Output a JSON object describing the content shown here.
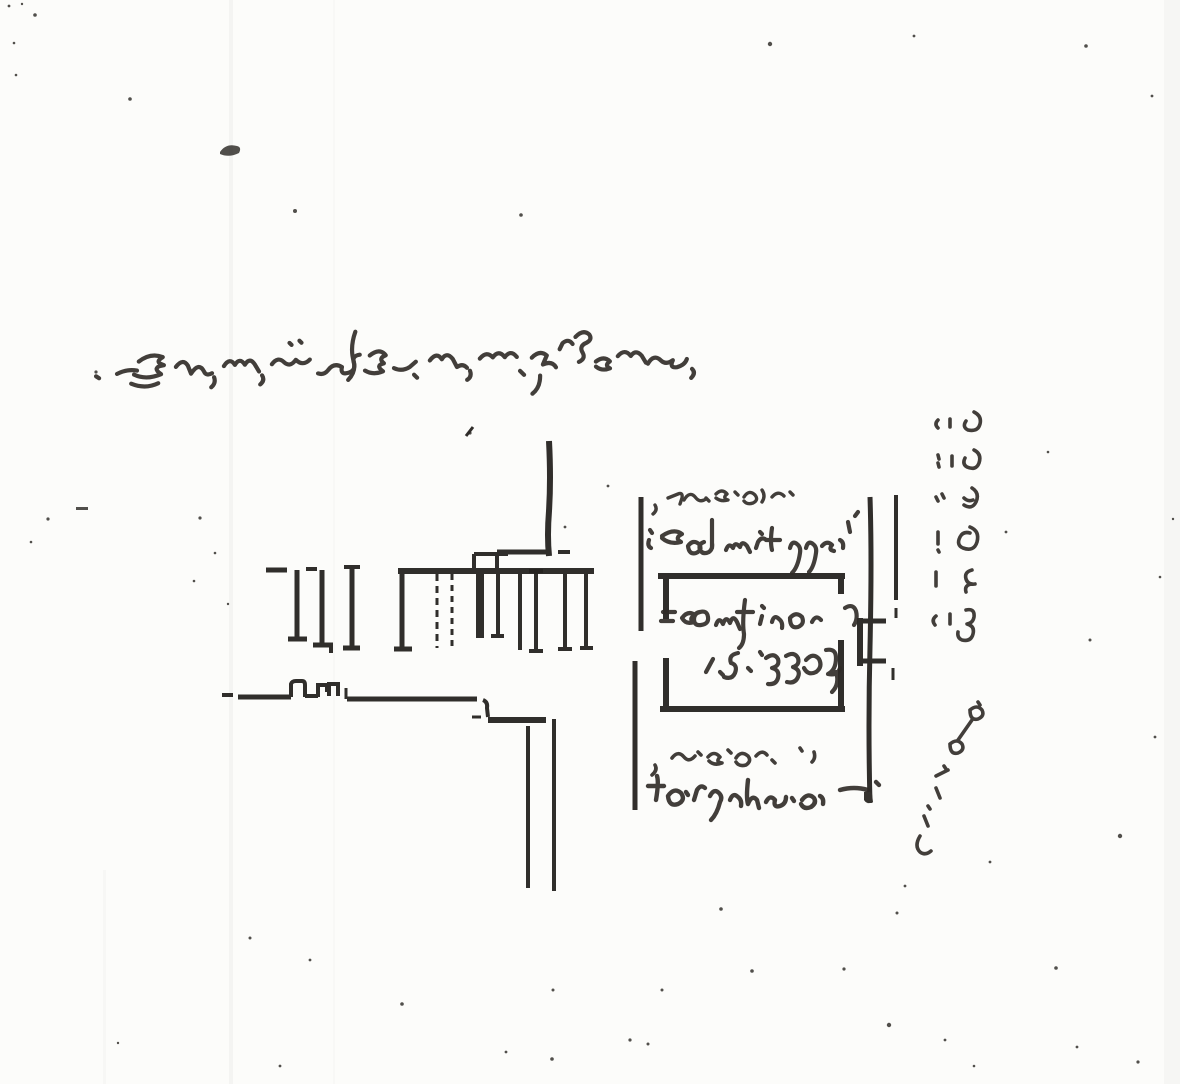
{
  "document": {
    "title": "Scanned hand-drawn floor-plan sketch",
    "description": "Photocopied page showing a hand-drawn apartment plan fragment with cursive handwritten annotations and scanner noise",
    "script_hint": "cursive handwriting (illegible)",
    "ink_color": "#2b2824",
    "paper_color": "#fcfcfa"
  },
  "annotations": {
    "title_line": {
      "role": "page heading",
      "lines": 1,
      "legibility": "illegible",
      "aria": "Handwritten cursive heading line across the upper page"
    },
    "upper_note": {
      "role": "note above room",
      "lines": 2,
      "legibility": "illegible",
      "aria": "Handwritten two-line note above the room rectangle"
    },
    "room_label": {
      "role": "label inside room",
      "lines": 2,
      "legibility": "illegible",
      "aria": "Handwritten label and dimension figures inside the room rectangle"
    },
    "lower_note": {
      "role": "note below room",
      "lines": 2,
      "legibility": "illegible",
      "aria": "Handwritten two-line note below the room rectangle"
    },
    "side_upper": {
      "role": "margin note",
      "orientation": "vertical",
      "legibility": "illegible",
      "aria": "Vertical handwritten margin column, upper block"
    },
    "side_lower": {
      "role": "margin note",
      "orientation": "vertical",
      "legibility": "illegible",
      "aria": "Vertical handwritten margin column, lower block"
    }
  },
  "plan": {
    "left_wing": {
      "aria": "Hand-drawn wall layout with door jambs and lower wall"
    },
    "stairs": {
      "aria": "Stair tread lines, two dashed"
    },
    "right_wing": {
      "aria": "Room rectangle with corridor verticals and door detail"
    }
  },
  "artifacts": {
    "blob": {
      "x": 228,
      "y": 150,
      "aria": "Dark ink blob"
    },
    "dashes": [
      [
        76,
        507,
        12,
        3
      ]
    ],
    "streaks": [
      [
        229,
        0,
        4,
        1084,
        0.05
      ],
      [
        333,
        0,
        2,
        1084,
        0.028
      ],
      [
        1164,
        0,
        16,
        1084,
        0.04
      ],
      [
        103,
        870,
        3,
        214,
        0.03
      ]
    ],
    "specks": [
      [
        9,
        6,
        1.4
      ],
      [
        22,
        4,
        1.2
      ],
      [
        35,
        15,
        1.8
      ],
      [
        14,
        43,
        1.3
      ],
      [
        130,
        99,
        1.8
      ],
      [
        295,
        211,
        2.0
      ],
      [
        521,
        215,
        1.8
      ],
      [
        770,
        44,
        2.2
      ],
      [
        914,
        36,
        1.4
      ],
      [
        1086,
        46,
        1.8
      ],
      [
        1152,
        96,
        1.4
      ],
      [
        16,
        75,
        1.3
      ],
      [
        96,
        372,
        1.6
      ],
      [
        48,
        519,
        1.6
      ],
      [
        31,
        542,
        1.3
      ],
      [
        200,
        518,
        1.6
      ],
      [
        215,
        553,
        1.3
      ],
      [
        194,
        581,
        1.3
      ],
      [
        228,
        604,
        1.2
      ],
      [
        470,
        433,
        1.6
      ],
      [
        565,
        527,
        1.4
      ],
      [
        608,
        486,
        1.4
      ],
      [
        1006,
        532,
        1.4
      ],
      [
        1048,
        452,
        1.3
      ],
      [
        1090,
        640,
        1.5
      ],
      [
        1120,
        836,
        2.2
      ],
      [
        1155,
        737,
        1.4
      ],
      [
        1160,
        577,
        1.3
      ],
      [
        1173,
        519,
        1.2
      ],
      [
        990,
        862,
        1.4
      ],
      [
        250,
        938,
        1.5
      ],
      [
        310,
        960,
        1.4
      ],
      [
        402,
        1004,
        1.8
      ],
      [
        506,
        1052,
        1.4
      ],
      [
        552,
        1059,
        1.8
      ],
      [
        630,
        1040,
        1.6
      ],
      [
        662,
        990,
        1.5
      ],
      [
        721,
        909,
        1.8
      ],
      [
        752,
        971,
        1.8
      ],
      [
        889,
        1025,
        2.2
      ],
      [
        897,
        913,
        1.5
      ],
      [
        945,
        1040,
        1.4
      ],
      [
        1056,
        968,
        1.8
      ],
      [
        1077,
        1047,
        1.4
      ],
      [
        1138,
        1062,
        1.6
      ],
      [
        974,
        1066,
        1.3
      ],
      [
        280,
        1066,
        1.4
      ],
      [
        118,
        1043,
        1.2
      ],
      [
        844,
        969,
        1.6
      ],
      [
        905,
        886,
        1.4
      ],
      [
        553,
        990,
        1.5
      ],
      [
        648,
        1044,
        1.5
      ]
    ]
  }
}
